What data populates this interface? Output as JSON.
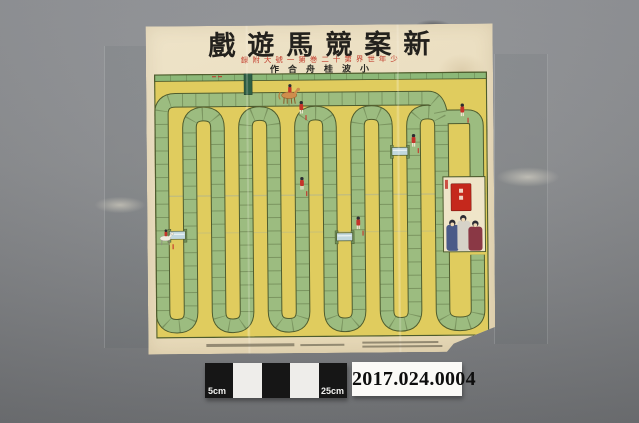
{
  "photo": {
    "background": {
      "top_color": "#96989c",
      "bottom_color": "#747679"
    },
    "scale_bar": {
      "segments": 5,
      "pattern": "black-white-black-white-black",
      "left_label": "5cm",
      "right_label": "25cm",
      "black": "#161616",
      "white": "#eeedea"
    },
    "catalog_label": {
      "number": "2017.024.0004",
      "bg_color": "#fbfaf7",
      "text_color": "#0e0e0e"
    }
  },
  "poster": {
    "paper_color": "#e9dcbd",
    "title": {
      "text": "戲遊馬競案新",
      "reading_right_to_left": "新案競馬遊戯",
      "color": "#23211d"
    },
    "subtitle": {
      "text": "録附大號一第巻二十第界世年少",
      "reading_right_to_left": "少年世界第十二巻第一號大附録",
      "color": "#c23b2b"
    },
    "credit": {
      "text": "作合舟桂波小",
      "reading_right_to_left": "小波桂舟合作",
      "color": "#2a2a24"
    },
    "board": {
      "field_color": "#e0cc5e",
      "track_color": "#9cbc80",
      "top_strip_color": "#8cb878",
      "outline_color": "#4e5c2e",
      "start_chute_color": "#2e5f45",
      "goal_banner_color": "#c5281c",
      "goal_box_bg": "#efe5c9",
      "track_layout": "serpentine, ~11 vertical runs with U-turns, start chute top center, finish box right side",
      "figures": [
        "mounted-jockey-start",
        "white-horse-jockey-left-edge",
        "standing-jockey-x4"
      ],
      "hurdle_bars": 3
    }
  }
}
